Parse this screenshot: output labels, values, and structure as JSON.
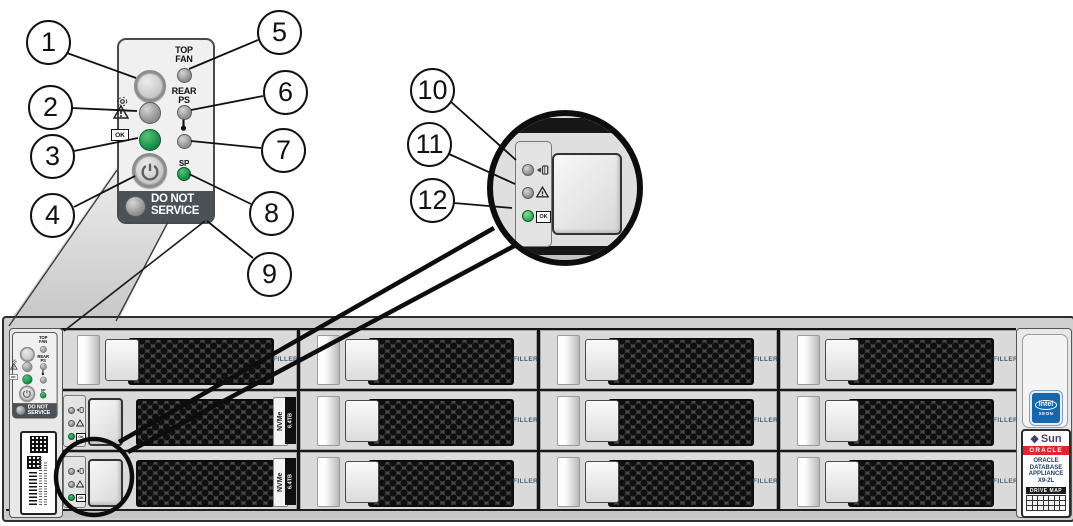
{
  "callouts": {
    "items": [
      "1",
      "2",
      "3",
      "4",
      "5",
      "6",
      "7",
      "8",
      "9",
      "10",
      "11",
      "12"
    ]
  },
  "control_panel": {
    "top_fan": {
      "line1": "TOP",
      "line2": "FAN"
    },
    "rear_ps": {
      "line1": "REAR",
      "line2": "PS"
    },
    "sp_label": "SP",
    "ok_label": "OK",
    "do_not_service": {
      "line1": "DO NOT",
      "line2": "SERVICE"
    }
  },
  "drive_panel": {
    "ok_label": "OK"
  },
  "drives": {
    "filler_label": "FILLER",
    "nvme_label": "NVMe",
    "capacity_label": "6.4TB"
  },
  "right_ear": {
    "intel_label": "intel",
    "xeon_label": "XEON",
    "sun_diamond": "◆",
    "sun_label": "Sun",
    "oracle_label": "ORACLE",
    "product": {
      "line1": "ORACLE",
      "line2": "DATABASE",
      "line3": "APPLIANCE",
      "line4": "X9-2L"
    },
    "drive_map_label": "DRIVE MAP"
  },
  "colors": {
    "led_green": "#128a43",
    "led_gray": "#969696",
    "oracle_red": "#e8242b",
    "filler_text": "#41617a",
    "panel_dark_strip": "#4b5257"
  }
}
